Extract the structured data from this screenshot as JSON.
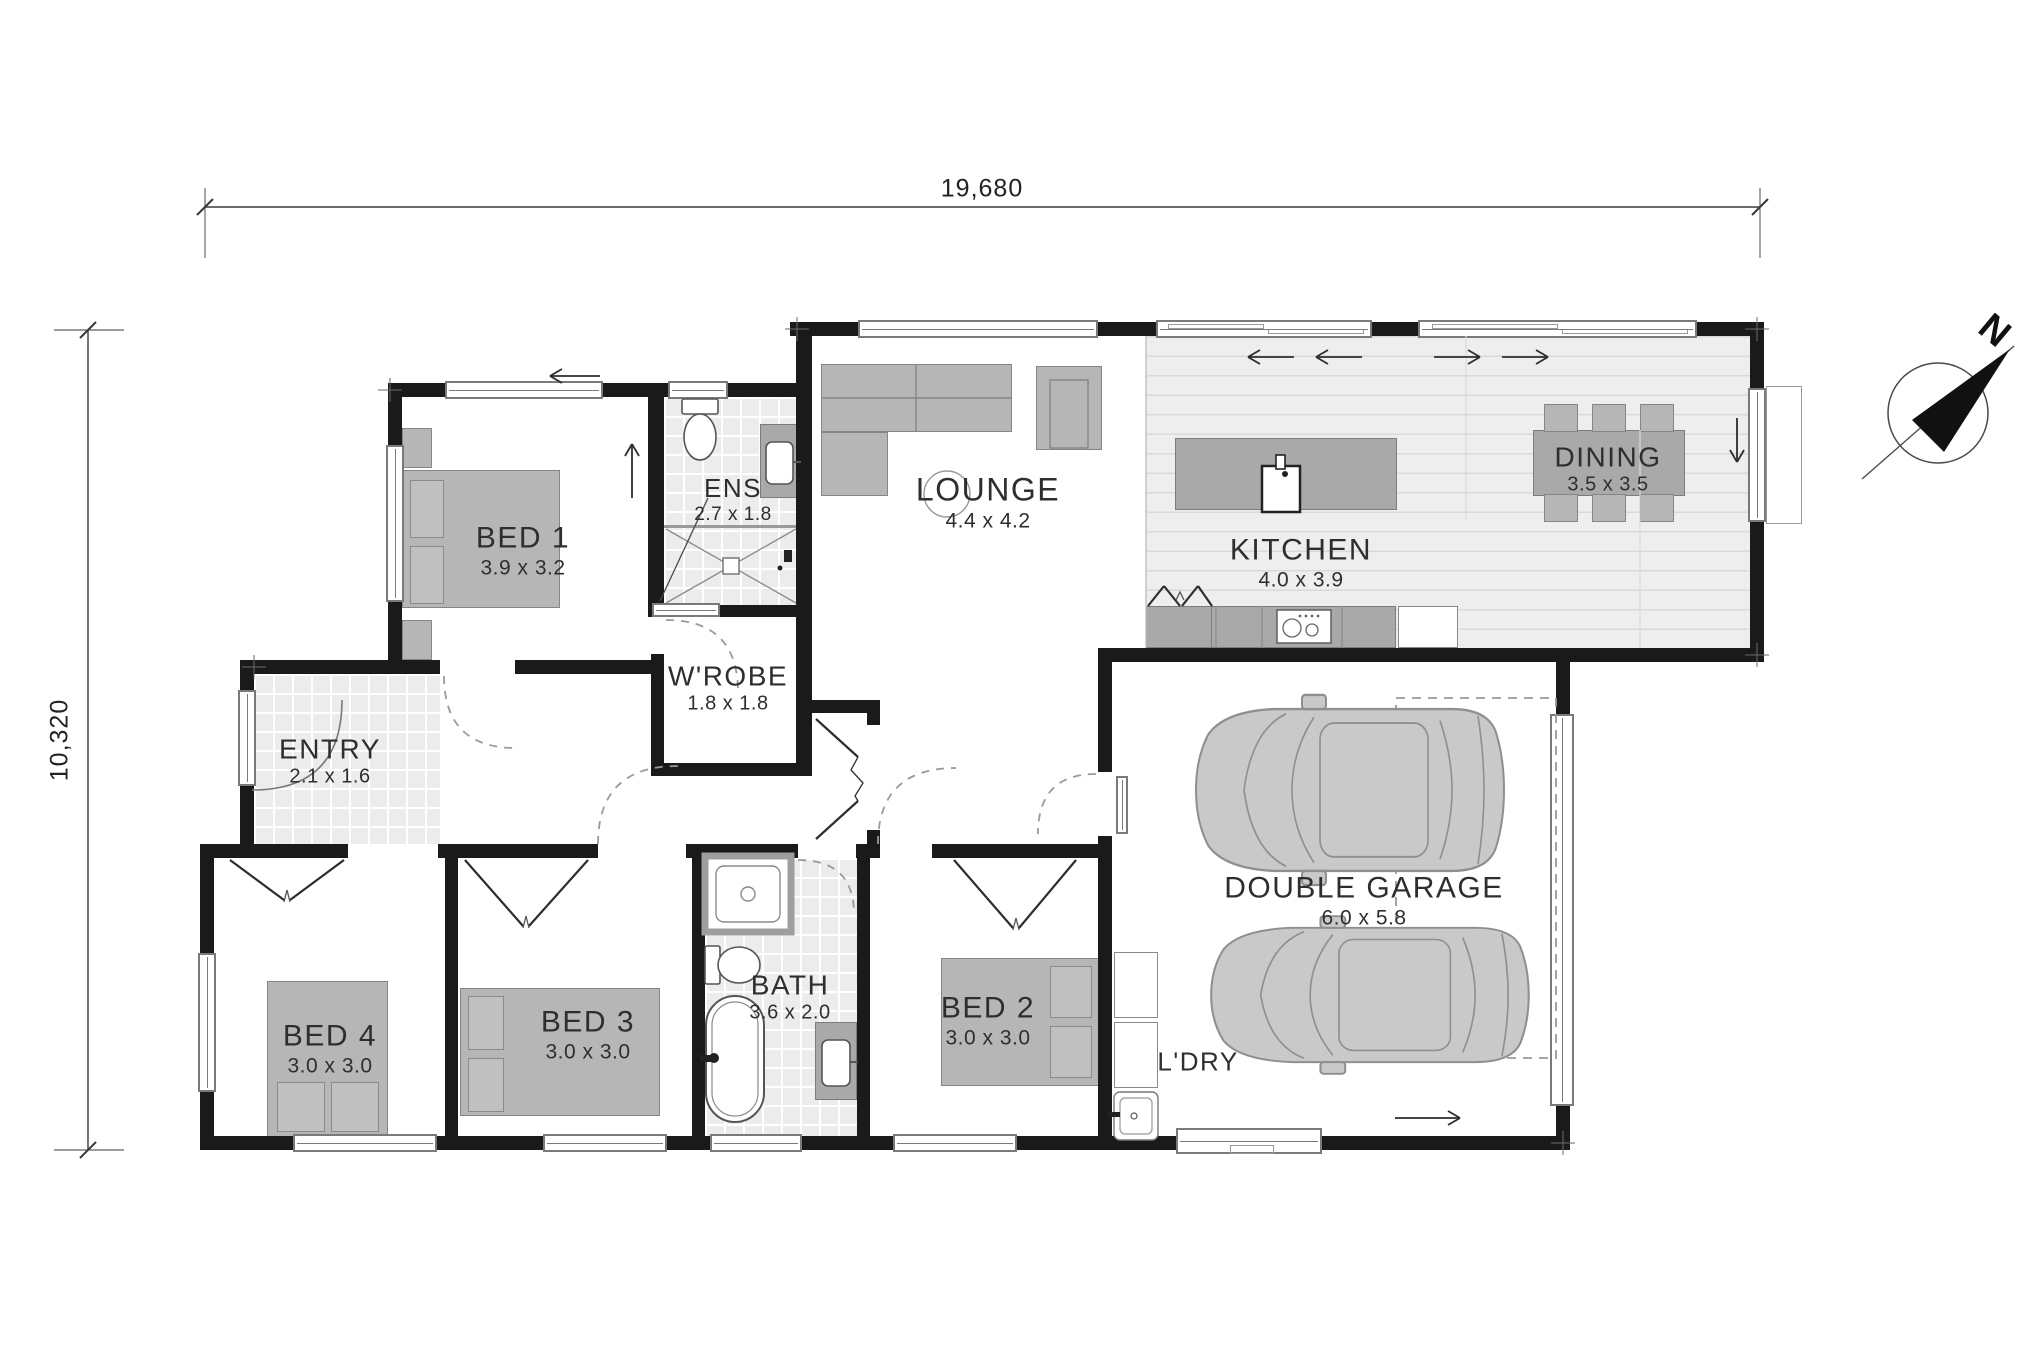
{
  "dimensions": {
    "overall_width": "19,680",
    "overall_depth": "10,320"
  },
  "compass": {
    "north": "N"
  },
  "rooms": {
    "bed1": {
      "name": "BED 1",
      "dims": "3.9 x 3.2"
    },
    "ens": {
      "name": "ENS",
      "dims": "2.7 x 1.8"
    },
    "wrobe": {
      "name": "W'ROBE",
      "dims": "1.8 x 1.8"
    },
    "lounge": {
      "name": "LOUNGE",
      "dims": "4.4 x 4.2"
    },
    "kitchen": {
      "name": "KITCHEN",
      "dims": "4.0 x 3.9"
    },
    "dining": {
      "name": "DINING",
      "dims": "3.5 x 3.5"
    },
    "entry": {
      "name": "ENTRY",
      "dims": "2.1 x 1.6"
    },
    "bed4": {
      "name": "BED 4",
      "dims": "3.0 x 3.0"
    },
    "bed3": {
      "name": "BED 3",
      "dims": "3.0 x 3.0"
    },
    "bath": {
      "name": "BATH",
      "dims": "3.6 x 2.0"
    },
    "bed2": {
      "name": "BED 2",
      "dims": "3.0 x 3.0"
    },
    "ldry": {
      "name": "L'DRY"
    },
    "garage": {
      "name": "DOUBLE GARAGE",
      "dims": "6.0 x 5.8"
    }
  },
  "colors": {
    "wall": "#1a1a1a",
    "furniture": "#b6b6b6",
    "floor_tile": "#ececec",
    "floor_plank": "#eeeeee",
    "text": "#2e2e2e"
  }
}
